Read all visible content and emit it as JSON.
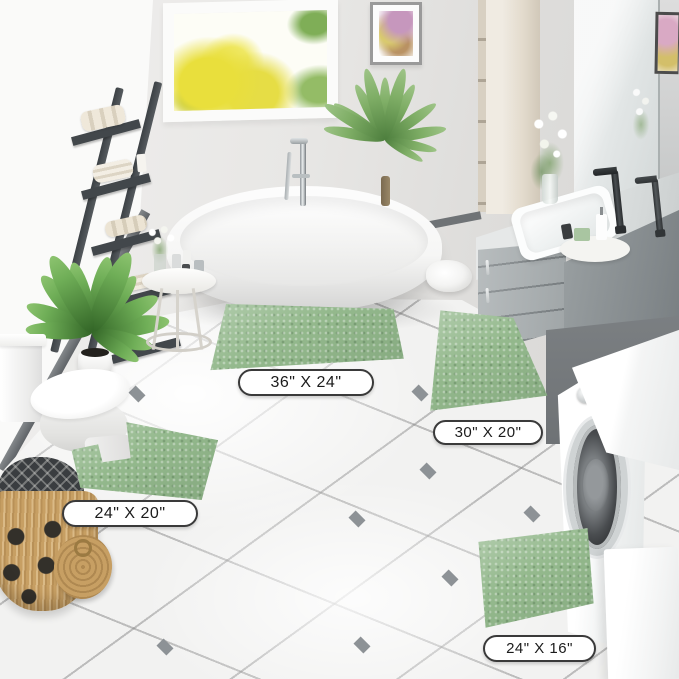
{
  "size_labels": [
    {
      "id": "rug-36x24",
      "text": "36\" X 24\""
    },
    {
      "id": "rug-30x20",
      "text": "30\" X 20\""
    },
    {
      "id": "rug-24x20",
      "text": "24\" X 20\""
    },
    {
      "id": "rug-24x16",
      "text": "24\" X 16\""
    }
  ],
  "colors": {
    "rug_green": "#94b98d",
    "rug_green_shadow": "#7aa173",
    "label_bg": "#ffffff",
    "label_border": "#3a3a3a",
    "label_text": "#1b1b1b",
    "floor": "#f2f2f1",
    "grout": "#bdbdbd",
    "tile_accent": "#8d9296",
    "wall_left": "#f7f7f6",
    "wall_back": "#e5e4e2",
    "baseboard": "#6f7477",
    "ladder": "#484d52",
    "vanity": "#a8aeb0",
    "counter": "#dcdfdf",
    "washer_wall": "#75797c",
    "basket": "#c79f63",
    "foliage_yellow": "#e9e04a",
    "foliage_green": "#7fae57",
    "plant_green": "#5e9349",
    "chrome": "#c7cccd",
    "black_fixture": "#2e3133"
  }
}
